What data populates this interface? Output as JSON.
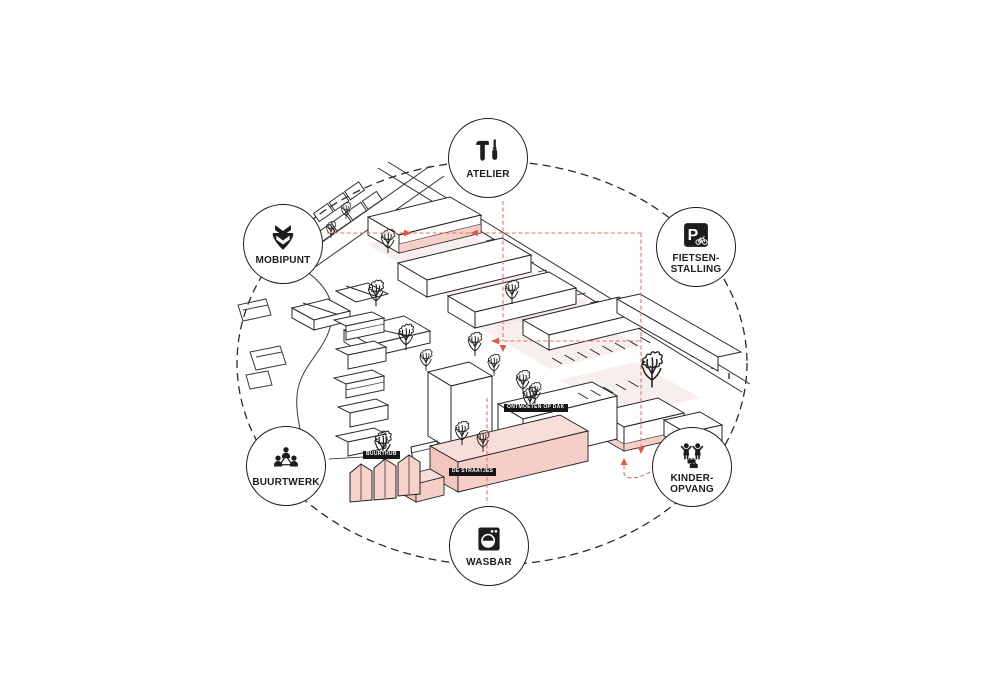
{
  "badges": [
    {
      "id": "atelier",
      "line1": "ATELIER",
      "line2": "",
      "icon": "tools-icon"
    },
    {
      "id": "mobipunt",
      "line1": "MOBIPUNT",
      "line2": "",
      "icon": "mobipunt-pin-icon"
    },
    {
      "id": "fietsenstalling",
      "line1": "FIETSEN-",
      "line2": "STALLING",
      "icon": "bicycle-parking-icon"
    },
    {
      "id": "buurtwerk",
      "line1": "BUURTWERK",
      "line2": "",
      "icon": "community-people-icon"
    },
    {
      "id": "kinderopvang",
      "line1": "KINDER-",
      "line2": "OPVANG",
      "icon": "children-icon"
    },
    {
      "id": "wasbar",
      "line1": "WASBAR",
      "line2": "",
      "icon": "washing-machine-icon"
    }
  ],
  "site_tags": [
    {
      "text": "ONTMOETEN OP DAK"
    },
    {
      "text": "BUURTHUB"
    },
    {
      "text": "DE STRAATJES"
    }
  ],
  "colors": {
    "ink": "#1d1d1b",
    "guide_red": "#ee6f61",
    "arrow_red": "#e4574b",
    "building_pink": "#f5cfc8",
    "pink_light": "#f8ded8",
    "ground_tint": "#efe1e0",
    "background": "#ffffff"
  }
}
